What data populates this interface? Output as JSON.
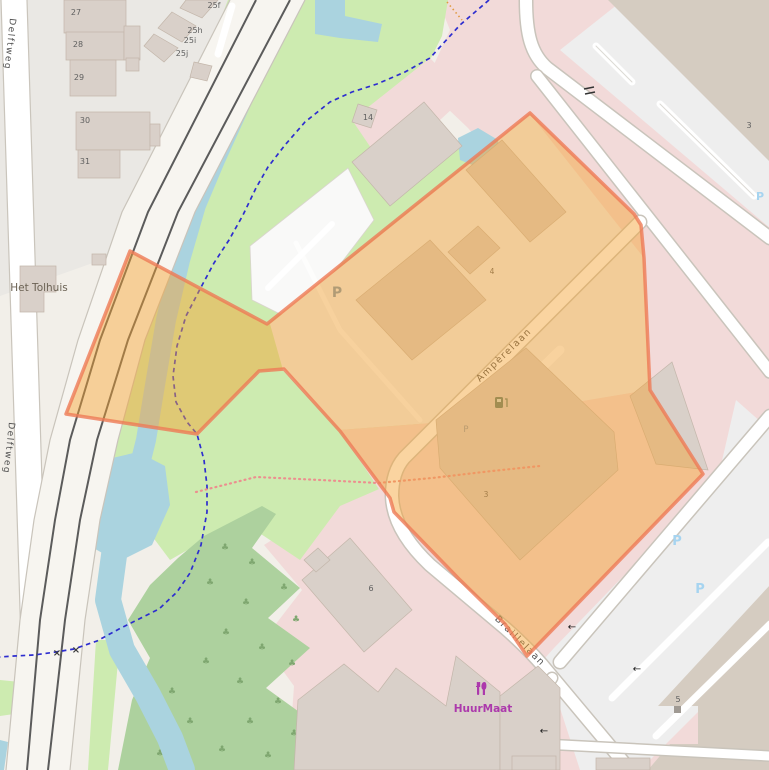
{
  "title": "Map view with highlighted parcel",
  "streets": {
    "delftweg": "Delftweg",
    "amperelaan": "Ampèrelaan",
    "braillelaan": "Braillelaan"
  },
  "places": {
    "het_tolhuis": "Het Tolhuis",
    "huurmaat": "HuurMaat"
  },
  "house_numbers": {
    "h27": "27",
    "h28": "28",
    "h29": "29",
    "h30": "30",
    "h31": "31",
    "h25f": "25f",
    "h25h": "25h",
    "h25i": "25i",
    "h25j": "25j",
    "h14": "14",
    "h3_ne": "3",
    "h4": "4",
    "h3_c": "3",
    "h6": "6",
    "h5": "5"
  },
  "symbols": {
    "parking": "P",
    "oneway_arrow": "←",
    "crossing": "×"
  },
  "overlay": {
    "name": "highlighted-area",
    "fill": "#f4a22f",
    "stroke": "#ee7a56"
  },
  "colors": {
    "land": "#f2efe9",
    "commercial_pink": "#f2dad9",
    "grass": "#cdebb0",
    "forest": "#add19e",
    "water": "#aad3df",
    "building": "#d9d0c9",
    "big_building_tan": "#d5ccc1",
    "parking_gray": "#eeeeee",
    "road": "#ffffff",
    "tram_rail": "#5b5b5b",
    "footpath_blue": "#2d2dcf",
    "boundary_dotted_pink": "#ec8f8f",
    "shop_magenta": "#ac39ac",
    "parking_blue": "#a6d4f0"
  }
}
